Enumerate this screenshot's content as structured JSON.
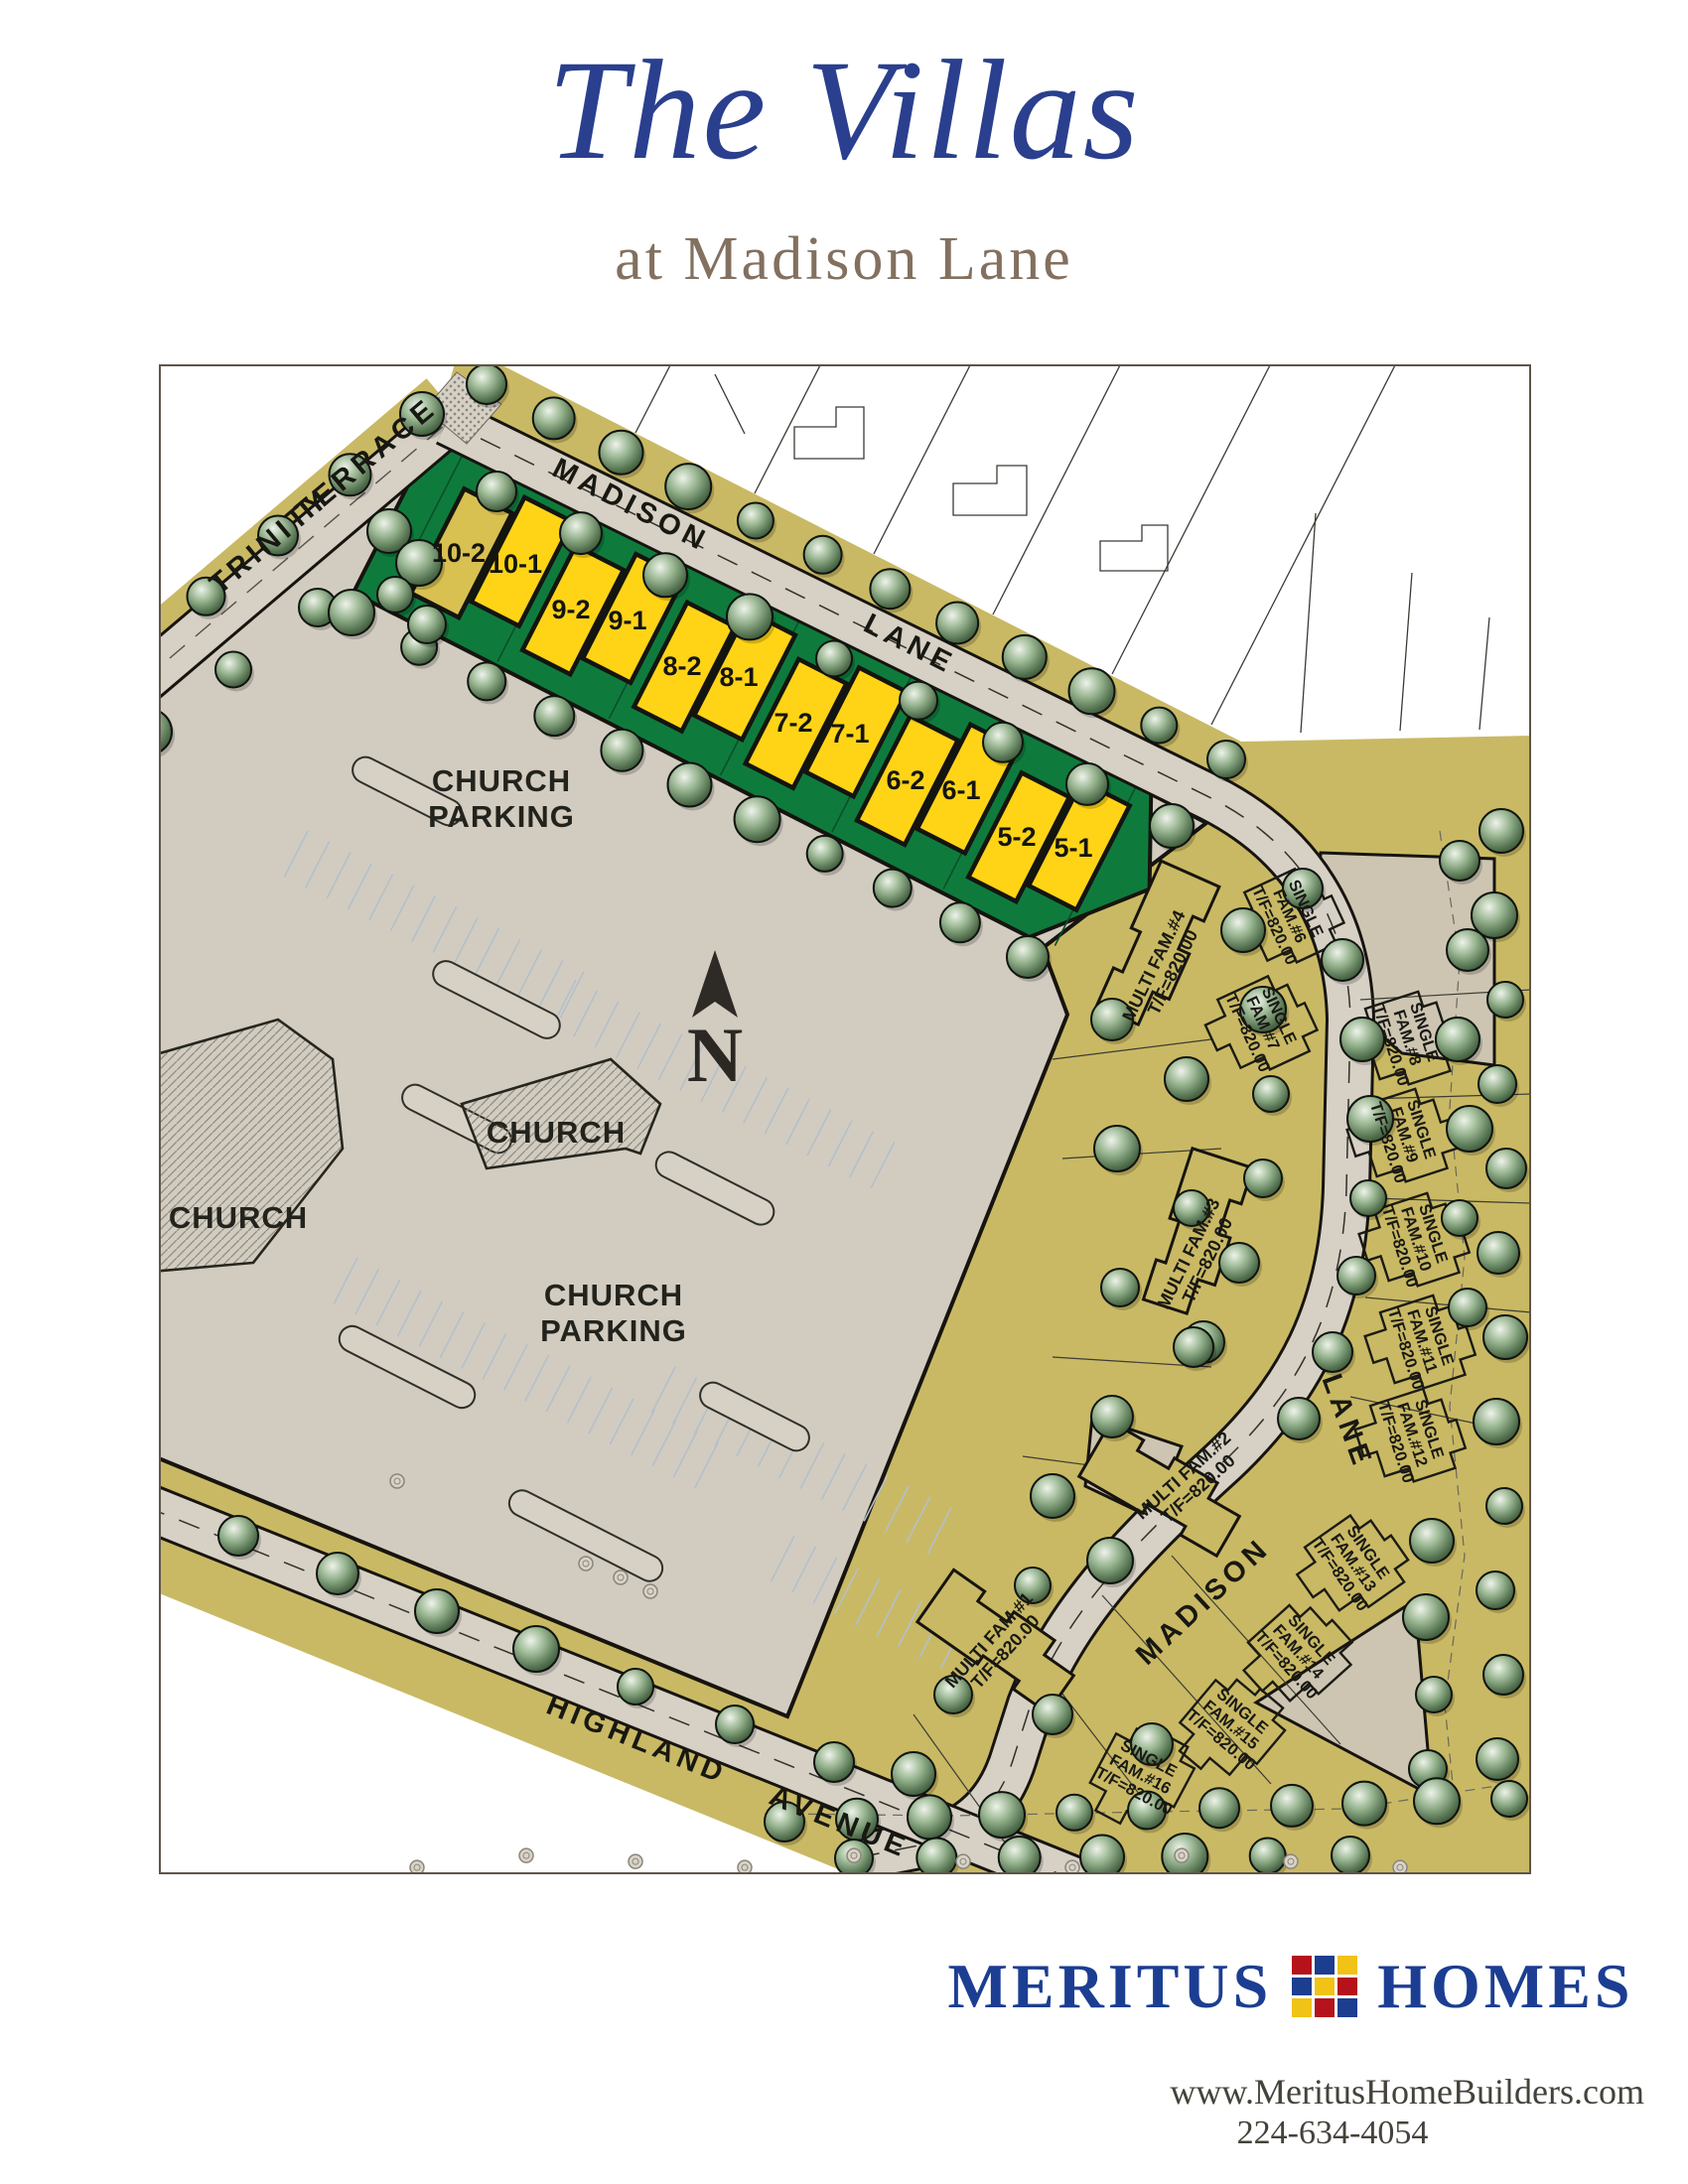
{
  "header": {
    "title": "The Villas",
    "subtitle": "at Madison Lane"
  },
  "map": {
    "streets": {
      "trinity": "TRINITY",
      "terrace": "TERRACE",
      "madison_top": "MADISON",
      "lane_top": "LANE",
      "madison_south": "MADISON",
      "lane_south": "LANE",
      "highland": "HIGHLAND",
      "avenue": "AVENUE"
    },
    "church": {
      "name_left": "CHURCH",
      "name_center": "CHURCH",
      "parking_word1": "CHURCH",
      "parking_word2": "PARKING"
    },
    "north_label": "N",
    "villa_units": [
      "10-2",
      "10-1",
      "9-2",
      "9-1",
      "8-2",
      "8-1",
      "7-2",
      "7-1",
      "6-2",
      "6-1",
      "5-2",
      "5-1"
    ],
    "lots": {
      "multi": [
        {
          "name": "MULTI FAM.#4",
          "tf": "T/F=820.00"
        },
        {
          "name": "MULTI FAM.#3",
          "tf": "T/F=820.00"
        },
        {
          "name": "MULTI FAM.#2",
          "tf": "T/F=820.00"
        },
        {
          "name": "MULTI FAM.#1",
          "tf": "T/F=820.00"
        }
      ],
      "single": [
        {
          "l1": "SINGLE",
          "l2": "FAM.#6",
          "tf": "T/F=820.00"
        },
        {
          "l1": "SINGLE",
          "l2": "FAM.#7",
          "tf": "T/F=820.00"
        },
        {
          "l1": "SINGLE",
          "l2": "FAM.#8",
          "tf": "T/F=820.00"
        },
        {
          "l1": "SINGLE",
          "l2": "FAM.#9",
          "tf": "T/F=820.00"
        },
        {
          "l1": "SINGLE",
          "l2": "FAM.#10",
          "tf": "T/F=820.00"
        },
        {
          "l1": "SINGLE",
          "l2": "FAM.#11",
          "tf": "T/F=820.00"
        },
        {
          "l1": "SINGLE",
          "l2": "FAM.#12",
          "tf": "T/F=820.00"
        },
        {
          "l1": "SINGLE",
          "l2": "FAM.#13",
          "tf": "T/F=820.00"
        },
        {
          "l1": "SINGLE",
          "l2": "FAM.#14",
          "tf": "T/F=820.00"
        },
        {
          "l1": "SINGLE",
          "l2": "FAM.#15",
          "tf": "T/F=820.00"
        },
        {
          "l1": "SINGLE",
          "l2": "FAM.#16",
          "tf": "T/F=820.00"
        }
      ]
    }
  },
  "footer": {
    "brand_word1": "MERITUS",
    "brand_word2": "HOMES",
    "website": "www.MeritusHomeBuilders.com",
    "phone": "224-634-4054",
    "logo_tiles": [
      "#b5121b",
      "#1d3d8f",
      "#f0c316",
      "#1d3d8f",
      "#f0c316",
      "#b5121b",
      "#f0c316",
      "#b5121b",
      "#1d3d8f"
    ]
  },
  "colors": {
    "accent_navy": "#2a3f8e",
    "brand_navy": "#1c3e92",
    "taupe": "#83705f",
    "villas_green": "#0e7b3d",
    "villa_yellow": "#ffd416",
    "villa_reserved_yellow": "#d8c051",
    "site_tan": "#c9b964",
    "road_gray": "#d6d0c5",
    "parking_gray": "#d2ccc0"
  }
}
